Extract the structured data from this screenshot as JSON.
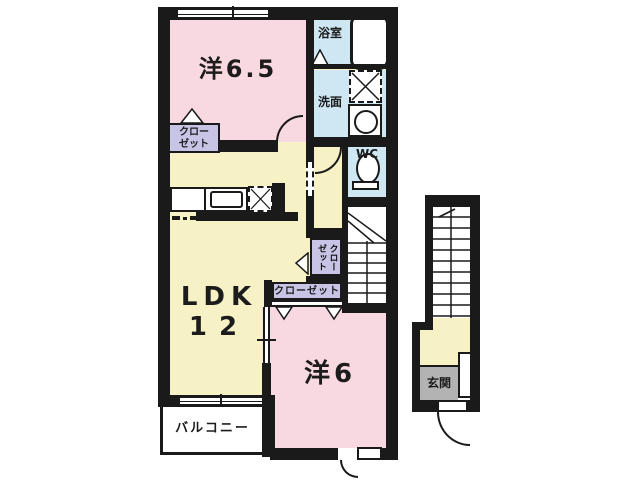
{
  "plan": {
    "type": "apartment-floor-plan",
    "rooms": {
      "western_room_65": {
        "label": "洋6.5"
      },
      "ldk": {
        "label_line1": "LDK",
        "label_line2": "12"
      },
      "western_room_6": {
        "label": "洋6"
      },
      "balcony": {
        "label": "バルコニー"
      },
      "bathroom": {
        "label": "浴室"
      },
      "washroom": {
        "label": "洗面"
      },
      "wc": {
        "label": "WC"
      },
      "entrance": {
        "label": "玄関"
      },
      "closet_top": {
        "line1": "クロー",
        "line2": "ゼット"
      },
      "closet_vertical": {
        "col_left": "ゼット",
        "col_right": "クロー"
      },
      "closet_horizontal": {
        "label": "クローゼット"
      }
    },
    "colors": {
      "wall": "#1a1a1a",
      "room_pink": "#f8d8e1",
      "ldk_yellow": "#f6f2c6",
      "wet_area_blue": "#cee7f2",
      "closet_purple": "#c7c4e6",
      "entrance_gray": "#b3b3b3",
      "background": "#ffffff"
    }
  }
}
